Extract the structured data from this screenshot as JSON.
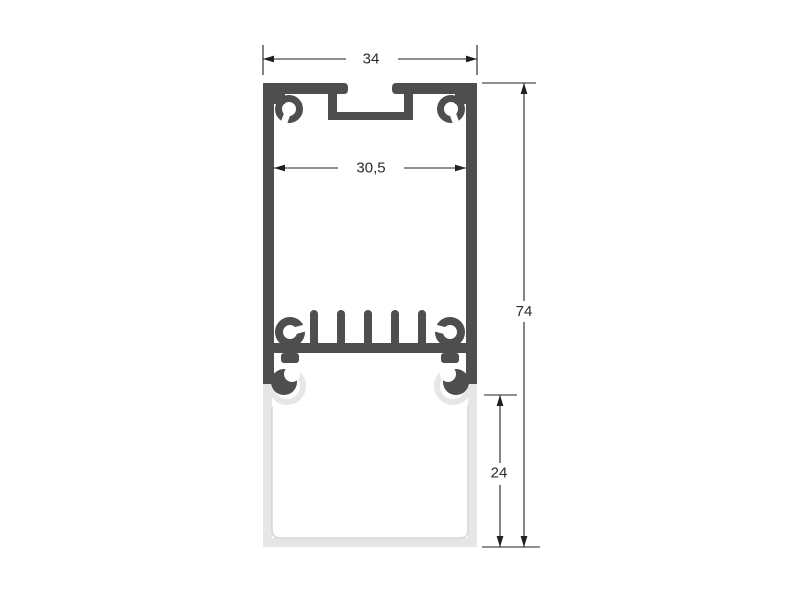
{
  "drawing": {
    "kind": "technical-cross-section",
    "subject": "aluminum-led-profile-with-diffuser",
    "dimension_labels": {
      "outer_width": "34",
      "inner_width": "30,5",
      "overall_height": "74",
      "diffuser_height": "24"
    },
    "colors": {
      "aluminum": "#4e4e4e",
      "diffuser": "#e6e6e6",
      "dimension_line": "#1f1f1f",
      "label_text": "#2b2b2b",
      "background": "#ffffff"
    }
  }
}
